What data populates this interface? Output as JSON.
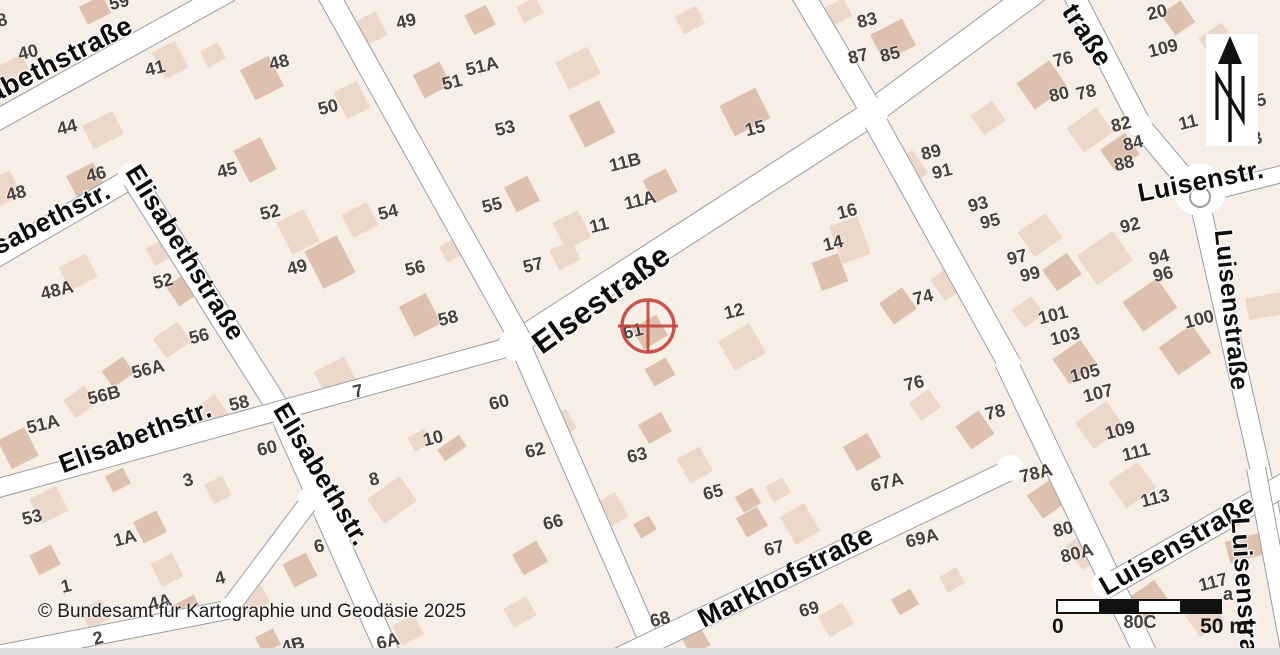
{
  "map": {
    "background": "#f7eee6",
    "street_fill": "#ffffff",
    "street_edge": "#9b9b9b",
    "number_color": "#45403b",
    "label_color": "#0d0d0d",
    "building_colors": [
      "#ecd8ca",
      "#ddc1ae"
    ],
    "streets": [
      [
        -30,
        135,
        230,
        -9,
        22
      ],
      [
        -30,
        272,
        135,
        176,
        22
      ],
      [
        128,
        170,
        287,
        422,
        24
      ],
      [
        284,
        420,
        392,
        662,
        24
      ],
      [
        -45,
        500,
        520,
        344,
        20
      ],
      [
        505,
        350,
        880,
        108,
        26
      ],
      [
        868,
        115,
        1048,
        -18,
        26
      ],
      [
        325,
        -12,
        520,
        338,
        23
      ],
      [
        518,
        340,
        660,
        665,
        22
      ],
      [
        793,
        -22,
        874,
        115,
        24
      ],
      [
        870,
        112,
        1010,
        365,
        24
      ],
      [
        1006,
        362,
        1150,
        663,
        24
      ],
      [
        598,
        668,
        1014,
        468,
        22
      ],
      [
        1062,
        -28,
        1142,
        127,
        22
      ],
      [
        1138,
        123,
        1192,
        187,
        22
      ],
      [
        1183,
        199,
        1298,
        170,
        18
      ],
      [
        1200,
        203,
        1287,
        588,
        21
      ],
      [
        1104,
        588,
        1298,
        477,
        24
      ],
      [
        1256,
        468,
        1292,
        660,
        20
      ],
      [
        -18,
        658,
        232,
        609,
        20
      ],
      [
        228,
        610,
        312,
        498,
        20
      ]
    ],
    "junctions": [
      [
        516,
        344,
        17
      ],
      [
        872,
        113,
        16
      ],
      [
        287,
        418,
        14
      ],
      [
        310,
        499,
        12
      ],
      [
        230,
        608,
        11
      ],
      [
        1010,
        468,
        13
      ],
      [
        1106,
        584,
        14
      ],
      [
        130,
        175,
        12
      ],
      [
        1140,
        125,
        12
      ],
      [
        1008,
        363,
        12
      ],
      [
        1200,
        190,
        26
      ]
    ],
    "roundabout": {
      "x": 1200,
      "y": 197,
      "r": 11
    },
    "buildings": [
      [
        12,
        75,
        36,
        28,
        -27,
        0
      ],
      [
        95,
        10,
        26,
        20,
        -27,
        1
      ],
      [
        170,
        60,
        26,
        30,
        -27,
        0
      ],
      [
        103,
        130,
        34,
        26,
        -27,
        0
      ],
      [
        85,
        180,
        30,
        24,
        -27,
        1
      ],
      [
        5,
        188,
        24,
        28,
        -27,
        0
      ],
      [
        262,
        78,
        32,
        34,
        -27,
        1
      ],
      [
        352,
        100,
        26,
        30,
        -27,
        0
      ],
      [
        213,
        55,
        20,
        18,
        -27,
        0
      ],
      [
        255,
        160,
        30,
        36,
        -27,
        1
      ],
      [
        298,
        232,
        30,
        36,
        -27,
        0
      ],
      [
        330,
        262,
        36,
        42,
        -27,
        1
      ],
      [
        78,
        272,
        30,
        26,
        -27,
        0
      ],
      [
        185,
        288,
        24,
        30,
        55,
        1
      ],
      [
        172,
        340,
        24,
        30,
        55,
        0
      ],
      [
        118,
        372,
        20,
        26,
        55,
        1
      ],
      [
        80,
        402,
        22,
        26,
        55,
        0
      ],
      [
        18,
        448,
        30,
        32,
        -27,
        1
      ],
      [
        210,
        412,
        24,
        28,
        55,
        0
      ],
      [
        160,
        252,
        22,
        20,
        -27,
        0
      ],
      [
        368,
        30,
        30,
        26,
        -27,
        0
      ],
      [
        432,
        80,
        30,
        26,
        -27,
        1
      ],
      [
        578,
        68,
        36,
        30,
        -27,
        0
      ],
      [
        592,
        124,
        34,
        36,
        -27,
        1
      ],
      [
        530,
        10,
        22,
        18,
        -27,
        0
      ],
      [
        480,
        20,
        24,
        22,
        -27,
        1
      ],
      [
        360,
        220,
        28,
        26,
        -27,
        0
      ],
      [
        522,
        194,
        26,
        28,
        -27,
        1
      ],
      [
        572,
        230,
        28,
        30,
        -27,
        0
      ],
      [
        660,
        186,
        26,
        26,
        -27,
        1
      ],
      [
        565,
        255,
        24,
        22,
        -27,
        0
      ],
      [
        420,
        315,
        30,
        34,
        -27,
        1
      ],
      [
        338,
        382,
        34,
        40,
        -27,
        0
      ],
      [
        452,
        250,
        20,
        18,
        -27,
        0
      ],
      [
        893,
        40,
        36,
        30,
        -27,
        1
      ],
      [
        838,
        12,
        22,
        20,
        -27,
        0
      ],
      [
        745,
        112,
        40,
        34,
        -27,
        1
      ],
      [
        690,
        20,
        24,
        20,
        -27,
        0
      ],
      [
        660,
        372,
        24,
        20,
        -30,
        1
      ],
      [
        742,
        347,
        36,
        34,
        -30,
        0
      ],
      [
        650,
        332,
        28,
        24,
        -30,
        1
      ],
      [
        850,
        240,
        30,
        40,
        -20,
        0
      ],
      [
        830,
        272,
        28,
        30,
        -20,
        1
      ],
      [
        950,
        282,
        26,
        30,
        55,
        0
      ],
      [
        898,
        306,
        26,
        28,
        55,
        1
      ],
      [
        925,
        405,
        22,
        24,
        55,
        0
      ],
      [
        975,
        430,
        28,
        28,
        55,
        1
      ],
      [
        908,
        170,
        28,
        30,
        55,
        0
      ],
      [
        1042,
        85,
        32,
        40,
        55,
        1
      ],
      [
        1090,
        130,
        30,
        36,
        55,
        0
      ],
      [
        1120,
        152,
        26,
        30,
        55,
        1
      ],
      [
        988,
        118,
        24,
        26,
        55,
        0
      ],
      [
        1178,
        18,
        26,
        24,
        55,
        1
      ],
      [
        1218,
        42,
        28,
        28,
        55,
        0
      ],
      [
        1105,
        258,
        36,
        44,
        55,
        0
      ],
      [
        1150,
        305,
        36,
        42,
        55,
        1
      ],
      [
        1040,
        235,
        30,
        34,
        55,
        0
      ],
      [
        1062,
        272,
        26,
        30,
        55,
        1
      ],
      [
        1028,
        312,
        22,
        24,
        55,
        0
      ],
      [
        1075,
        362,
        30,
        34,
        55,
        1
      ],
      [
        1100,
        425,
        32,
        38,
        55,
        0
      ],
      [
        1185,
        350,
        34,
        40,
        55,
        1
      ],
      [
        1132,
        485,
        32,
        36,
        55,
        0
      ],
      [
        1048,
        498,
        28,
        32,
        55,
        1
      ],
      [
        1088,
        548,
        30,
        34,
        55,
        0
      ],
      [
        1150,
        600,
        28,
        30,
        55,
        1
      ],
      [
        1205,
        618,
        26,
        30,
        55,
        0
      ],
      [
        1245,
        548,
        22,
        36,
        75,
        1
      ],
      [
        1272,
        305,
        22,
        50,
        80,
        0
      ],
      [
        560,
        425,
        26,
        22,
        -30,
        0
      ],
      [
        655,
        428,
        26,
        22,
        -30,
        1
      ],
      [
        608,
        512,
        32,
        28,
        -30,
        0
      ],
      [
        645,
        527,
        18,
        16,
        -30,
        1
      ],
      [
        800,
        524,
        28,
        32,
        -30,
        0
      ],
      [
        748,
        500,
        20,
        18,
        -30,
        1
      ],
      [
        778,
        490,
        20,
        18,
        -30,
        0
      ],
      [
        862,
        452,
        28,
        28,
        -30,
        1
      ],
      [
        695,
        465,
        26,
        28,
        -30,
        0
      ],
      [
        752,
        522,
        24,
        22,
        -30,
        1
      ],
      [
        836,
        620,
        28,
        24,
        -30,
        0
      ],
      [
        905,
        602,
        22,
        18,
        -30,
        1
      ],
      [
        952,
        580,
        20,
        18,
        -30,
        0
      ],
      [
        695,
        640,
        22,
        24,
        -30,
        1
      ],
      [
        392,
        500,
        30,
        40,
        55,
        0
      ],
      [
        452,
        448,
        14,
        26,
        55,
        1
      ],
      [
        420,
        440,
        20,
        16,
        -30,
        0
      ],
      [
        530,
        558,
        28,
        24,
        -30,
        1
      ],
      [
        49,
        505,
        30,
        28,
        -27,
        0
      ],
      [
        150,
        527,
        26,
        24,
        -27,
        1
      ],
      [
        167,
        570,
        24,
        26,
        -27,
        0
      ],
      [
        188,
        610,
        24,
        22,
        -27,
        1
      ],
      [
        95,
        614,
        24,
        22,
        -27,
        0
      ],
      [
        45,
        560,
        24,
        22,
        -27,
        1
      ],
      [
        252,
        598,
        28,
        24,
        -27,
        0
      ],
      [
        300,
        570,
        26,
        26,
        -27,
        1
      ],
      [
        408,
        630,
        24,
        22,
        -27,
        0
      ],
      [
        268,
        641,
        20,
        18,
        -27,
        1
      ],
      [
        218,
        490,
        20,
        22,
        -27,
        0
      ],
      [
        118,
        480,
        20,
        18,
        -27,
        1
      ],
      [
        520,
        612,
        26,
        22,
        -30,
        0
      ]
    ],
    "street_labels": [
      [
        "Elisabethstraße",
        -55,
        122,
        -27,
        27
      ],
      [
        "Elisabethstr.",
        -35,
        265,
        -27,
        26
      ],
      [
        "Elisabethstraße",
        132,
        170,
        58,
        26
      ],
      [
        "Elisabethstr.",
        60,
        468,
        -21,
        26
      ],
      [
        "Elisabethstr.",
        280,
        408,
        59,
        26
      ],
      [
        "Elsestraße",
        536,
        350,
        -36,
        31
      ],
      [
        "Markhofstraße",
        700,
        624,
        -27,
        27
      ],
      [
        "Luisenstr.",
        1138,
        196,
        -11,
        26
      ],
      [
        "Luisenstraße",
        1222,
        232,
        84,
        25
      ],
      [
        "Luisenstraße",
        1102,
        592,
        -30,
        27
      ],
      [
        "Luisenstraße",
        1240,
        520,
        86,
        26
      ],
      [
        "traße",
        1068,
        10,
        57,
        27
      ]
    ],
    "house_numbers": [
      [
        "40",
        28,
        52
      ],
      [
        "41",
        155,
        68
      ],
      [
        "48",
        279,
        62
      ],
      [
        "44",
        67,
        127
      ],
      [
        "50",
        328,
        107
      ],
      [
        "46",
        96,
        174
      ],
      [
        "48",
        16,
        193
      ],
      [
        "45",
        227,
        170
      ],
      [
        "52",
        270,
        212
      ],
      [
        "49",
        297,
        267
      ],
      [
        "52",
        163,
        281
      ],
      [
        "48A",
        57,
        290
      ],
      [
        "56",
        199,
        336
      ],
      [
        "56A",
        148,
        369
      ],
      [
        "56B",
        104,
        395
      ],
      [
        "51A",
        43,
        424
      ],
      [
        "58",
        239,
        403
      ],
      [
        "59",
        119,
        2
      ],
      [
        "8",
        2,
        20
      ],
      [
        "49",
        406,
        21
      ],
      [
        "51A",
        482,
        66
      ],
      [
        "51",
        452,
        82
      ],
      [
        "53",
        505,
        128
      ],
      [
        "11B",
        625,
        162
      ],
      [
        "11A",
        640,
        200
      ],
      [
        "54",
        388,
        212
      ],
      [
        "55",
        492,
        205
      ],
      [
        "11",
        599,
        225
      ],
      [
        "57",
        533,
        265
      ],
      [
        "56",
        415,
        268
      ],
      [
        "58",
        448,
        318
      ],
      [
        "7",
        358,
        391
      ],
      [
        "60",
        499,
        402
      ],
      [
        "61",
        633,
        331
      ],
      [
        "12",
        734,
        311
      ],
      [
        "10",
        433,
        438
      ],
      [
        "8",
        374,
        479
      ],
      [
        "62",
        535,
        450
      ],
      [
        "63",
        637,
        455
      ],
      [
        "66",
        553,
        522
      ],
      [
        "60",
        267,
        448
      ],
      [
        "3",
        188,
        480
      ],
      [
        "53",
        32,
        517
      ],
      [
        "1A",
        125,
        538
      ],
      [
        "6",
        319,
        546
      ],
      [
        "4",
        220,
        578
      ],
      [
        "1",
        66,
        586
      ],
      [
        "4A",
        160,
        602
      ],
      [
        "2",
        98,
        638
      ],
      [
        "4B",
        293,
        645
      ],
      [
        "6A",
        388,
        641
      ],
      [
        "68",
        660,
        619
      ],
      [
        "65",
        713,
        492
      ],
      [
        "67",
        774,
        548
      ],
      [
        "67A",
        887,
        482
      ],
      [
        "69",
        809,
        609
      ],
      [
        "69A",
        922,
        538
      ],
      [
        "83",
        867,
        20
      ],
      [
        "87",
        858,
        56
      ],
      [
        "85",
        890,
        54
      ],
      [
        "15",
        755,
        128
      ],
      [
        "89",
        931,
        152
      ],
      [
        "91",
        942,
        171
      ],
      [
        "16",
        847,
        211
      ],
      [
        "14",
        833,
        243
      ],
      [
        "74",
        923,
        297
      ],
      [
        "76",
        914,
        383
      ],
      [
        "78",
        995,
        412
      ],
      [
        "93",
        978,
        204
      ],
      [
        "95",
        990,
        221
      ],
      [
        "97",
        1017,
        257
      ],
      [
        "99",
        1030,
        274
      ],
      [
        "92",
        1130,
        225
      ],
      [
        "94",
        1159,
        257
      ],
      [
        "96",
        1163,
        274
      ],
      [
        "100",
        1199,
        319
      ],
      [
        "101",
        1053,
        315
      ],
      [
        "103",
        1065,
        336
      ],
      [
        "105",
        1085,
        373
      ],
      [
        "107",
        1098,
        393
      ],
      [
        "109",
        1120,
        430
      ],
      [
        "111",
        1136,
        452
      ],
      [
        "78A",
        1036,
        473
      ],
      [
        "113",
        1155,
        498
      ],
      [
        "80",
        1063,
        529
      ],
      [
        "80A",
        1077,
        553
      ],
      [
        "117",
        1213,
        582
      ],
      [
        "80C",
        1140,
        622,
        0
      ],
      [
        "76",
        1063,
        59
      ],
      [
        "80",
        1059,
        94
      ],
      [
        "78",
        1086,
        92
      ],
      [
        "82",
        1121,
        124
      ],
      [
        "84",
        1133,
        143
      ],
      [
        "88",
        1124,
        163
      ],
      [
        "20",
        1157,
        12
      ],
      [
        "109",
        1163,
        48
      ],
      [
        "11",
        1188,
        122
      ],
      [
        "5",
        1261,
        100
      ],
      [
        "3",
        1257,
        138
      ],
      [
        "a",
        1228,
        594,
        0
      ]
    ],
    "marker": {
      "x": 648,
      "y": 326,
      "r": 26,
      "color": "#c1443c"
    }
  },
  "north_arrow": {
    "x": 1206,
    "y": 34,
    "width": 52,
    "height": 112,
    "letter": "N"
  },
  "scale_bar": {
    "x": 1056,
    "y": 599,
    "width": 166,
    "seg_colors": [
      "#ffffff",
      "#111111",
      "#ffffff",
      "#111111"
    ],
    "label_start": "0",
    "label_end": "50 m"
  },
  "copyright": {
    "text": "© Bundesamt für Kartographie und Geodäsie 2025",
    "x": 38,
    "y": 601
  }
}
